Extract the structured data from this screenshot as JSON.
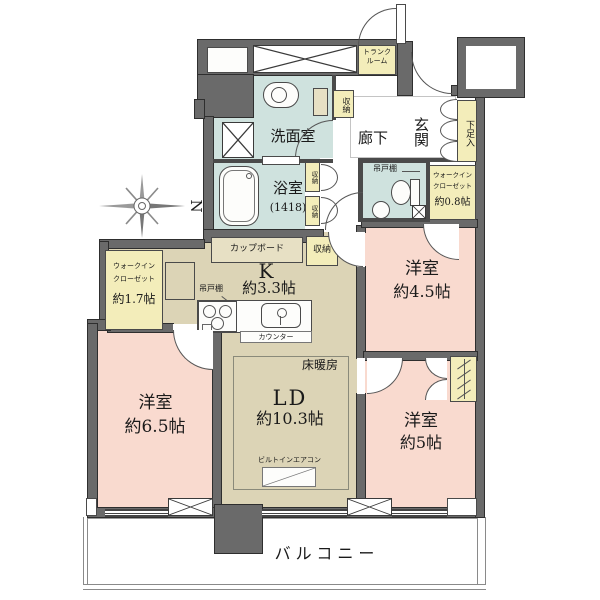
{
  "colors": {
    "wall": "#6a6a6a",
    "room_pink": "#f9dacf",
    "room_beige": "#dcd4b6",
    "room_yellow": "#f3edba",
    "room_blue": "#cfe2de"
  },
  "plan": {
    "compass_label": "N",
    "balcony": "バルコニー",
    "trunk_room": {
      "line1": "トランク",
      "line2": "ルーム"
    },
    "entrance": "玄関",
    "shoe_cabinet": "下足入",
    "hallway": "廊下",
    "washroom": "洗面室",
    "bathroom": {
      "name": "浴室",
      "size": "(1418)"
    },
    "storage_hall": "収納",
    "storage_small_upper": "収納",
    "storage_small_lower": "収納",
    "toilet_shelf": "吊戸棚",
    "wic_small": {
      "line1": "ウォークイン",
      "line2": "クローゼット",
      "size": "約0.8帖"
    },
    "wic_large": {
      "line1": "ウォークイン",
      "line2": "クローゼット",
      "size": "約1.7帖"
    },
    "kitchen": {
      "name": "K",
      "size": "約3.3帖",
      "cupboard": "カップボード",
      "storage": "収納",
      "shelf": "吊戸棚",
      "counter": "カウンター"
    },
    "living": {
      "name": "LD",
      "size": "約10.3帖",
      "floor_heating": "床暖房",
      "aircon": "ビルトインエアコン"
    },
    "bedroom_65": {
      "name": "洋室",
      "size": "約6.5帖"
    },
    "bedroom_45": {
      "name": "洋室",
      "size": "約4.5帖"
    },
    "bedroom_5": {
      "name": "洋室",
      "size": "約5帖"
    }
  }
}
